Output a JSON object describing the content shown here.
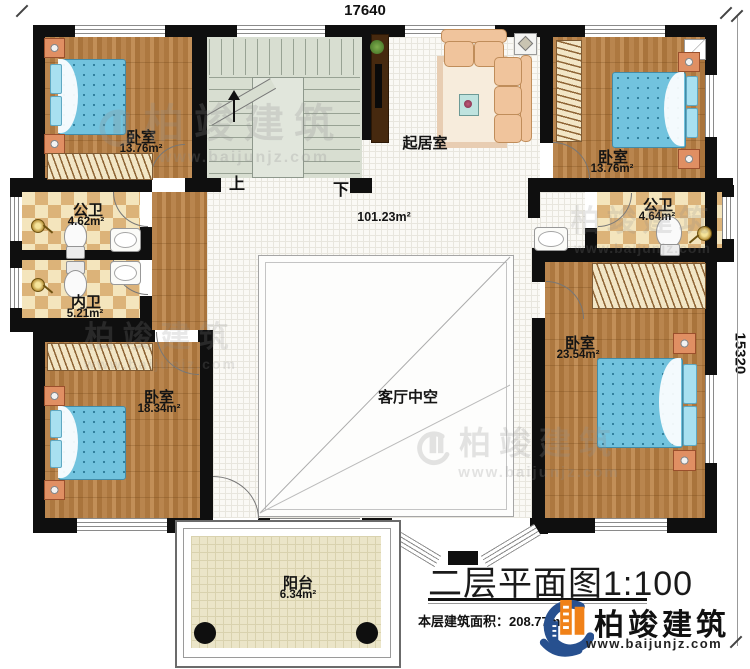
{
  "dimensions": {
    "top": "17640",
    "right": "15320"
  },
  "rooms": {
    "bedroom_top_left": {
      "name": "卧室",
      "area": "13.76m²"
    },
    "bedroom_top_right": {
      "name": "卧室",
      "area": "13.76m²"
    },
    "bedroom_bottom_left": {
      "name": "卧室",
      "area": "18.34m²"
    },
    "bedroom_bottom_right": {
      "name": "卧室",
      "area": "23.54m²"
    },
    "bath_public_left": {
      "name": "公卫",
      "area": "4.62m²"
    },
    "bath_private_left": {
      "name": "内卫",
      "area": "5.21m²"
    },
    "bath_public_right": {
      "name": "公卫",
      "area": "4.64m²"
    },
    "living_room": {
      "name": "起居室",
      "area": "101.23m²"
    },
    "void": {
      "name": "客厅中空"
    },
    "balcony": {
      "name": "阳台",
      "area": "6.34m²"
    },
    "stairs": {
      "up": "上",
      "down": "下"
    }
  },
  "title_block": {
    "title": "二层平面图1:100",
    "floor_area_note": "本层建筑面积：208.77m²"
  },
  "branding": {
    "company": "柏竣建筑",
    "website": "www.baijunjz.com"
  },
  "watermark": {
    "company": "柏竣建筑",
    "website": "www.baijunjz.com"
  },
  "colors": {
    "wall": "#0f0f0f",
    "wood": "#b5804a",
    "bath_tile": "#dcb379",
    "bed": "#72c3de",
    "stairs": "#d8ded1",
    "balcony": "#ebe5c8",
    "logo_blue": "#27508f",
    "logo_orange": "#f08118"
  }
}
